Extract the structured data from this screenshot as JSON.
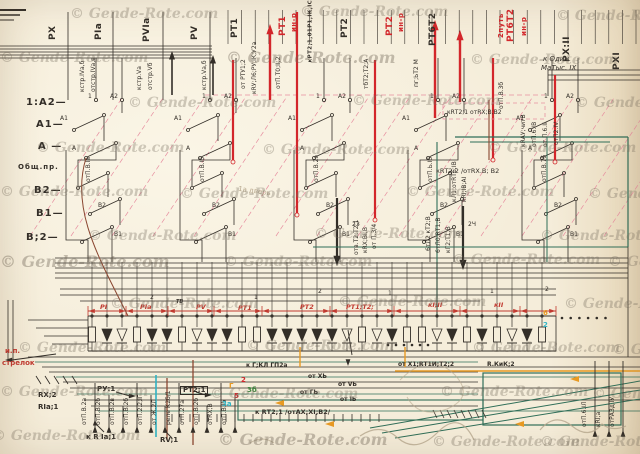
{
  "watermark": {
    "text": "© Gende-Rote.com"
  },
  "colors": {
    "ink": "#332e28",
    "red": "#c13a30",
    "bright_red": "#d3262b",
    "pink": "#e78fa0",
    "green": "#2f6e58",
    "green2": "#3f8a3f",
    "orange": "#e89a22",
    "cyan": "#2fb3c4",
    "maroon": "#8a4630",
    "pencil": "#b7a88e",
    "paper": "#f4ecd9"
  },
  "labels": {
    "top": [
      {
        "t": "РХ",
        "x": 58,
        "y": 40
      },
      {
        "t": "РIа",
        "x": 104,
        "y": 40
      },
      {
        "t": "РVIа",
        "x": 152,
        "y": 42
      },
      {
        "t": "РV",
        "x": 200,
        "y": 40
      },
      {
        "t": "РТ1",
        "x": 240,
        "y": 38
      },
      {
        "t": "РТ1",
        "x": 288,
        "y": 36,
        "c": "bright_red"
      },
      {
        "t": "ин-р",
        "x": 298,
        "y": 34,
        "c": "bright_red",
        "fs": 7
      },
      {
        "t": "кРТ2;1,01Р1,IК,IС",
        "x": 314,
        "y": 66,
        "fs": 5.5
      },
      {
        "t": "РТ2",
        "x": 350,
        "y": 38
      },
      {
        "t": "РТ2",
        "x": 395,
        "y": 36,
        "c": "bright_red"
      },
      {
        "t": "ин-р",
        "x": 405,
        "y": 34,
        "c": "bright_red",
        "fs": 7
      },
      {
        "t": "РТ6Т2",
        "x": 438,
        "y": 46
      },
      {
        "t": "2путь",
        "x": 505,
        "y": 40,
        "c": "bright_red",
        "fs": 7
      },
      {
        "t": "РТ6Т2",
        "x": 516,
        "y": 42,
        "c": "bright_red"
      },
      {
        "t": "ин-р",
        "x": 528,
        "y": 38,
        "c": "bright_red",
        "fs": 7
      },
      {
        "t": "РХ:II",
        "x": 572,
        "y": 62
      },
      {
        "t": "РХI",
        "x": 622,
        "y": 70
      }
    ],
    "left": [
      {
        "t": "1:А2—",
        "x": 26,
        "y": 98
      },
      {
        "t": "А1—",
        "x": 36,
        "y": 120
      },
      {
        "t": "А —",
        "x": 38,
        "y": 142
      },
      {
        "t": "Общ.пр.",
        "x": 18,
        "y": 164,
        "fs": 7
      },
      {
        "t": "В2—",
        "x": 34,
        "y": 186
      },
      {
        "t": "В1—",
        "x": 36,
        "y": 209
      },
      {
        "t": "В;2—",
        "x": 26,
        "y": 233
      }
    ],
    "band": [
      {
        "t": "РI",
        "x": 100,
        "y": 304
      },
      {
        "t": "РIа",
        "x": 140,
        "y": 304
      },
      {
        "t": "ТВ",
        "x": 176,
        "y": 300,
        "c": "ink",
        "fs": 5
      },
      {
        "t": "РV",
        "x": 196,
        "y": 304
      },
      {
        "t": "РТ1",
        "x": 238,
        "y": 305
      },
      {
        "t": "РТ2",
        "x": 300,
        "y": 304
      },
      {
        "t": "РТ1;Т2;",
        "x": 346,
        "y": 304
      },
      {
        "t": "кI;II",
        "x": 428,
        "y": 302
      },
      {
        "t": "кII",
        "x": 494,
        "y": 302
      }
    ],
    "band_nums": [
      {
        "t": "2",
        "x": 150,
        "y": 295
      },
      {
        "t": "1",
        "x": 254,
        "y": 295
      },
      {
        "t": "2",
        "x": 318,
        "y": 289
      },
      {
        "t": "1",
        "x": 388,
        "y": 291
      },
      {
        "t": "1",
        "x": 490,
        "y": 289
      },
      {
        "t": "2",
        "x": 545,
        "y": 287
      }
    ],
    "group_terms": [
      "1",
      "А2",
      "А1",
      "А",
      "В2",
      "В1"
    ],
    "mid": [
      {
        "t": "кRТ2;1 отRХ;В;В2",
        "x": 447,
        "y": 110,
        "fs": 6
      },
      {
        "t": "кRТ2:2 /отRХ.В; В2",
        "x": 436,
        "y": 168,
        "fs": 6.5
      },
      {
        "t": "к Один.",
        "x": 543,
        "y": 56,
        "fs": 7,
        "hand": 1
      },
      {
        "t": "МаТыс. IХ",
        "x": 541,
        "y": 65,
        "fs": 7,
        "hand": 1
      },
      {
        "t": "2З",
        "x": 352,
        "y": 222,
        "fs": 6
      },
      {
        "t": "2Ч",
        "x": 468,
        "y": 222,
        "fs": 6
      },
      {
        "t": "1а дверь",
        "x": 238,
        "y": 188,
        "fs": 7,
        "c": "pencil",
        "r": 8
      }
    ],
    "bottom": [
      {
        "t": "и.п.",
        "x": 5,
        "y": 348,
        "c": "red"
      },
      {
        "t": "стрелок",
        "x": 2,
        "y": 360,
        "c": "red"
      },
      {
        "t": "RX;2",
        "x": 38,
        "y": 392
      },
      {
        "t": "RIа;1",
        "x": 38,
        "y": 404
      },
      {
        "t": "РУ:1",
        "x": 97,
        "y": 386
      },
      {
        "t": "РТ2;1",
        "x": 180,
        "y": 386,
        "box": 1
      },
      {
        "t": "к R Iа;1",
        "x": 86,
        "y": 434
      },
      {
        "t": "RV;1",
        "x": 160,
        "y": 437
      },
      {
        "t": "к Г;КЛ ГП2а",
        "x": 246,
        "y": 363,
        "fs": 6
      },
      {
        "t": "от ХЬ",
        "x": 308,
        "y": 374,
        "fs": 6
      },
      {
        "t": "от VЬ",
        "x": 338,
        "y": 382,
        "fs": 6
      },
      {
        "t": "от ГЬ",
        "x": 300,
        "y": 390,
        "fs": 6
      },
      {
        "t": "от IЬ",
        "x": 340,
        "y": 397,
        "fs": 6
      },
      {
        "t": "к RТ2;1 /отАХ;ХI;В2/",
        "x": 255,
        "y": 409,
        "fs": 6.5
      },
      {
        "t": "от Х1;RТ1И;Т2;2",
        "x": 398,
        "y": 362,
        "fs": 6
      },
      {
        "t": "R.КиК;2",
        "x": 487,
        "y": 362,
        "fs": 6
      }
    ],
    "tiny_top": [
      {
        "t": "кстр.IVа,б",
        "x": 86,
        "y": 95
      },
      {
        "t": "отстр.IVа,в",
        "x": 97,
        "y": 95
      },
      {
        "t": "кстр.Vа",
        "x": 143,
        "y": 93
      },
      {
        "t": "отстр.Vб",
        "x": 154,
        "y": 93
      },
      {
        "t": "кстр.Vа,б",
        "x": 208,
        "y": 93
      },
      {
        "t": "от РТУ1;2",
        "x": 247,
        "y": 92
      },
      {
        "t": "кRУ;Л6;РУ;IК;У2а",
        "x": 258,
        "y": 97
      },
      {
        "t": "отП.Т0;II;2",
        "x": 282,
        "y": 92
      },
      {
        "t": "тбТ2;Т2;А",
        "x": 370,
        "y": 92
      },
      {
        "t": "пг;ЬТ2 М",
        "x": 420,
        "y": 90
      },
      {
        "t": "отП.В.3б",
        "x": 505,
        "y": 112
      },
      {
        "t": "отП.В.Iа",
        "x": 92,
        "y": 185
      },
      {
        "t": "отП.В.Iб",
        "x": 206,
        "y": 185
      },
      {
        "t": "отП.В.2а",
        "x": 320,
        "y": 185
      },
      {
        "t": "отП.Ь.Iб",
        "x": 434,
        "y": 185
      },
      {
        "t": "отП.В.7б",
        "x": 548,
        "y": 185
      },
      {
        "t": "отв.Т2;Т2;1",
        "x": 360,
        "y": 258
      },
      {
        "t": "кRХ;ВI;В",
        "x": 369,
        "y": 256
      },
      {
        "t": "от П.3/4",
        "x": 378,
        "y": 252
      },
      {
        "t": "6тЛ2 кТ2;В",
        "x": 432,
        "y": 254
      },
      {
        "t": "6тЛ0;RТ1;В",
        "x": 442,
        "y": 256
      },
      {
        "t": "кГ2;Т1;В",
        "x": 452,
        "y": 256
      },
      {
        "t": "кЛ1;отRТ6;IВ",
        "x": 458,
        "y": 205
      },
      {
        "t": "кRI;IВ;АI",
        "x": 468,
        "y": 205
      },
      {
        "t": "кRАУ;читВ",
        "x": 527,
        "y": 150
      },
      {
        "t": "отП.6.IВ",
        "x": 538,
        "y": 150
      },
      {
        "t": "от П.6.II",
        "x": 549,
        "y": 150
      },
      {
        "t": "отП2.IV",
        "x": 560,
        "y": 148
      }
    ],
    "tiny_bottom": [
      {
        "t": "отП.В.2а",
        "x": 88,
        "y": 428
      },
      {
        "t": "отП.В.2б",
        "x": 102,
        "y": 428
      },
      {
        "t": "отП.В.2в",
        "x": 116,
        "y": 428
      },
      {
        "t": "отП.В.2б",
        "x": 130,
        "y": 428
      },
      {
        "t": "отП.2.2;IГ",
        "x": 144,
        "y": 428
      },
      {
        "t": "от Ж.2Л",
        "x": 158,
        "y": 428
      },
      {
        "t": "реле К2б/1",
        "x": 172,
        "y": 428
      },
      {
        "t": "отП.27а",
        "x": 186,
        "y": 428
      },
      {
        "t": "отП.В.2б",
        "x": 200,
        "y": 428
      },
      {
        "t": "отRХ;В",
        "x": 214,
        "y": 428
      },
      {
        "t": "отП.В.Iб",
        "x": 228,
        "y": 428
      }
    ],
    "tiny_right": [
      {
        "t": "отП.6.IЛ",
        "x": 588,
        "y": 430
      },
      {
        "t": "кRI;а",
        "x": 602,
        "y": 430
      },
      {
        "t": "отРАЗд.IУ",
        "x": 616,
        "y": 430
      }
    ],
    "annotations": [
      {
        "t": "Г",
        "x": 229,
        "y": 383,
        "c": "orange"
      },
      {
        "t": "2",
        "x": 241,
        "y": 377,
        "c": "bright_red"
      },
      {
        "t": "5",
        "x": 234,
        "y": 393,
        "c": "bright_red"
      },
      {
        "t": "3а",
        "x": 222,
        "y": 401,
        "c": "cyan"
      },
      {
        "t": "3б",
        "x": 247,
        "y": 387,
        "c": "green2"
      },
      {
        "t": "6",
        "x": 543,
        "y": 310,
        "c": "orange"
      },
      {
        "t": "2",
        "x": 543,
        "y": 322,
        "c": "cyan"
      }
    ]
  },
  "band_pattern": [
    "r",
    "df",
    "do",
    "r",
    "df",
    "df",
    "r",
    "do",
    "df",
    "df",
    "r",
    "r",
    "df",
    "df",
    "df",
    "df",
    "df",
    "do",
    "r",
    "do",
    "df",
    "r",
    "r",
    "do",
    "df",
    "r",
    "df",
    "r",
    "do",
    "df",
    "r"
  ]
}
